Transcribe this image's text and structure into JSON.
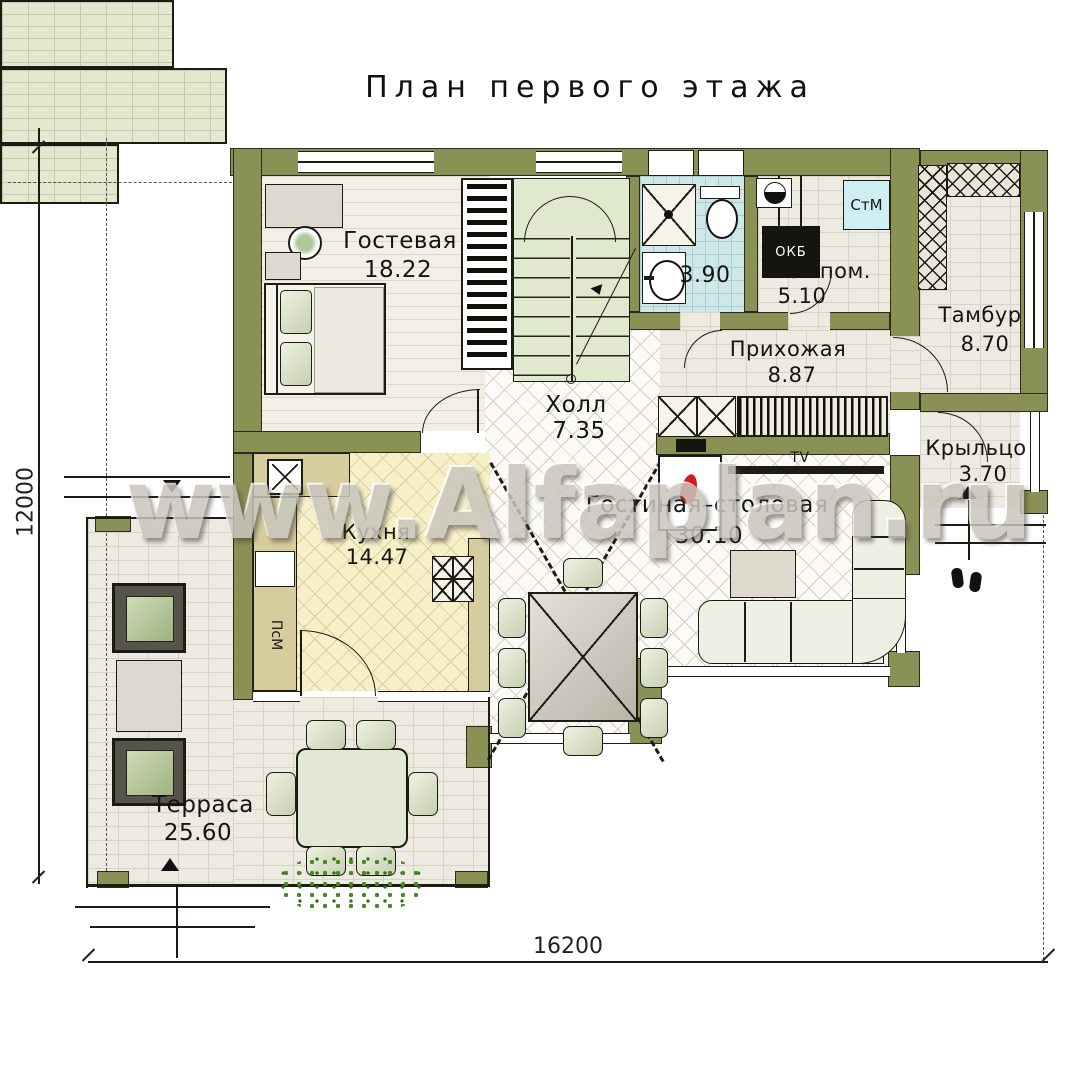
{
  "title": "План первого этажа",
  "watermark": "www.Alfaplan.ru",
  "dimensions": {
    "bottom": "16200",
    "left": "12000"
  },
  "rooms": {
    "guest": {
      "name": "Гостевая",
      "area": "18.22"
    },
    "hall": {
      "name": "Холл",
      "area": "7.35"
    },
    "bath": {
      "area": "3.90"
    },
    "tech": {
      "name": "Тех пом.",
      "area": "5.10"
    },
    "entry": {
      "name": "Прихожая",
      "area": "8.87"
    },
    "tambour": {
      "name": "Тамбур",
      "area": "8.70"
    },
    "porch": {
      "name": "Крыльцо",
      "area": "3.70"
    },
    "kitchen": {
      "name": "Кухня",
      "area": "14.47"
    },
    "living": {
      "name": "Гостиная–столовая",
      "area": "30.10"
    },
    "terrace": {
      "name": "Терраса",
      "area": "25.60"
    }
  },
  "appliances": {
    "washer": "СтМ",
    "dishwasher": "ПсМ",
    "boiler": "ОКБ",
    "tv": "TV"
  }
}
